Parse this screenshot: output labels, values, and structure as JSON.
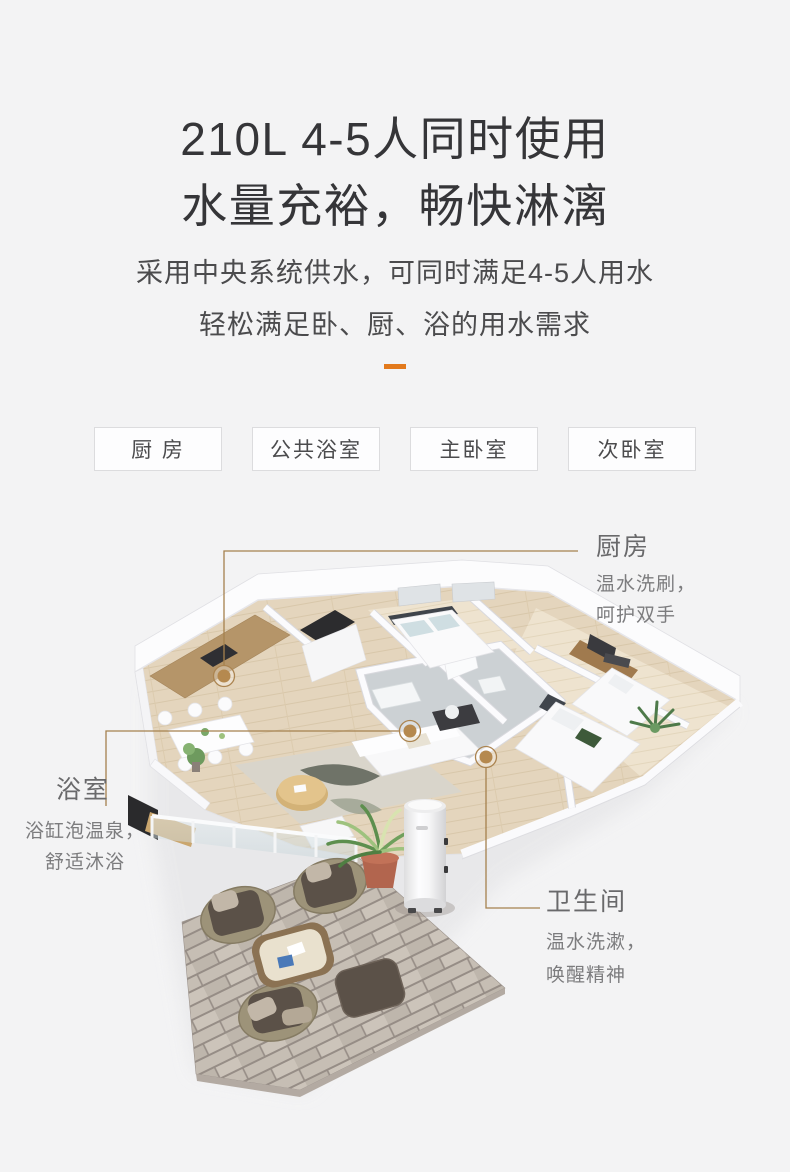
{
  "header": {
    "title_line1": "210L 4-5人同时使用",
    "title_line2": "水量充裕，畅快淋漓",
    "subtitle_line1": "采用中央系统供水，可同时满足4-5人用水",
    "subtitle_line2": "轻松满足卧、厨、浴的用水需求"
  },
  "room_tabs": [
    {
      "label": "厨 房"
    },
    {
      "label": "公共浴室"
    },
    {
      "label": "主卧室"
    },
    {
      "label": "次卧室"
    }
  ],
  "callouts": {
    "kitchen": {
      "title": "厨房",
      "desc_line1": "温水洗刷，",
      "desc_line2": "呵护双手"
    },
    "bathroom": {
      "title": "浴室",
      "desc_line1": "浴缸泡温泉，",
      "desc_line2": "舒适沐浴"
    },
    "toilet": {
      "title": "卫生间",
      "desc_line1": "温水洗漱，",
      "desc_line2": "唤醒精神"
    }
  },
  "colors": {
    "background": "#f3f3f4",
    "accent_orange": "#e2791c",
    "callout_line": "#a5814e",
    "callout_dot": "#b5894f",
    "title_text": "#353538",
    "tab_border": "#dcdcde"
  }
}
